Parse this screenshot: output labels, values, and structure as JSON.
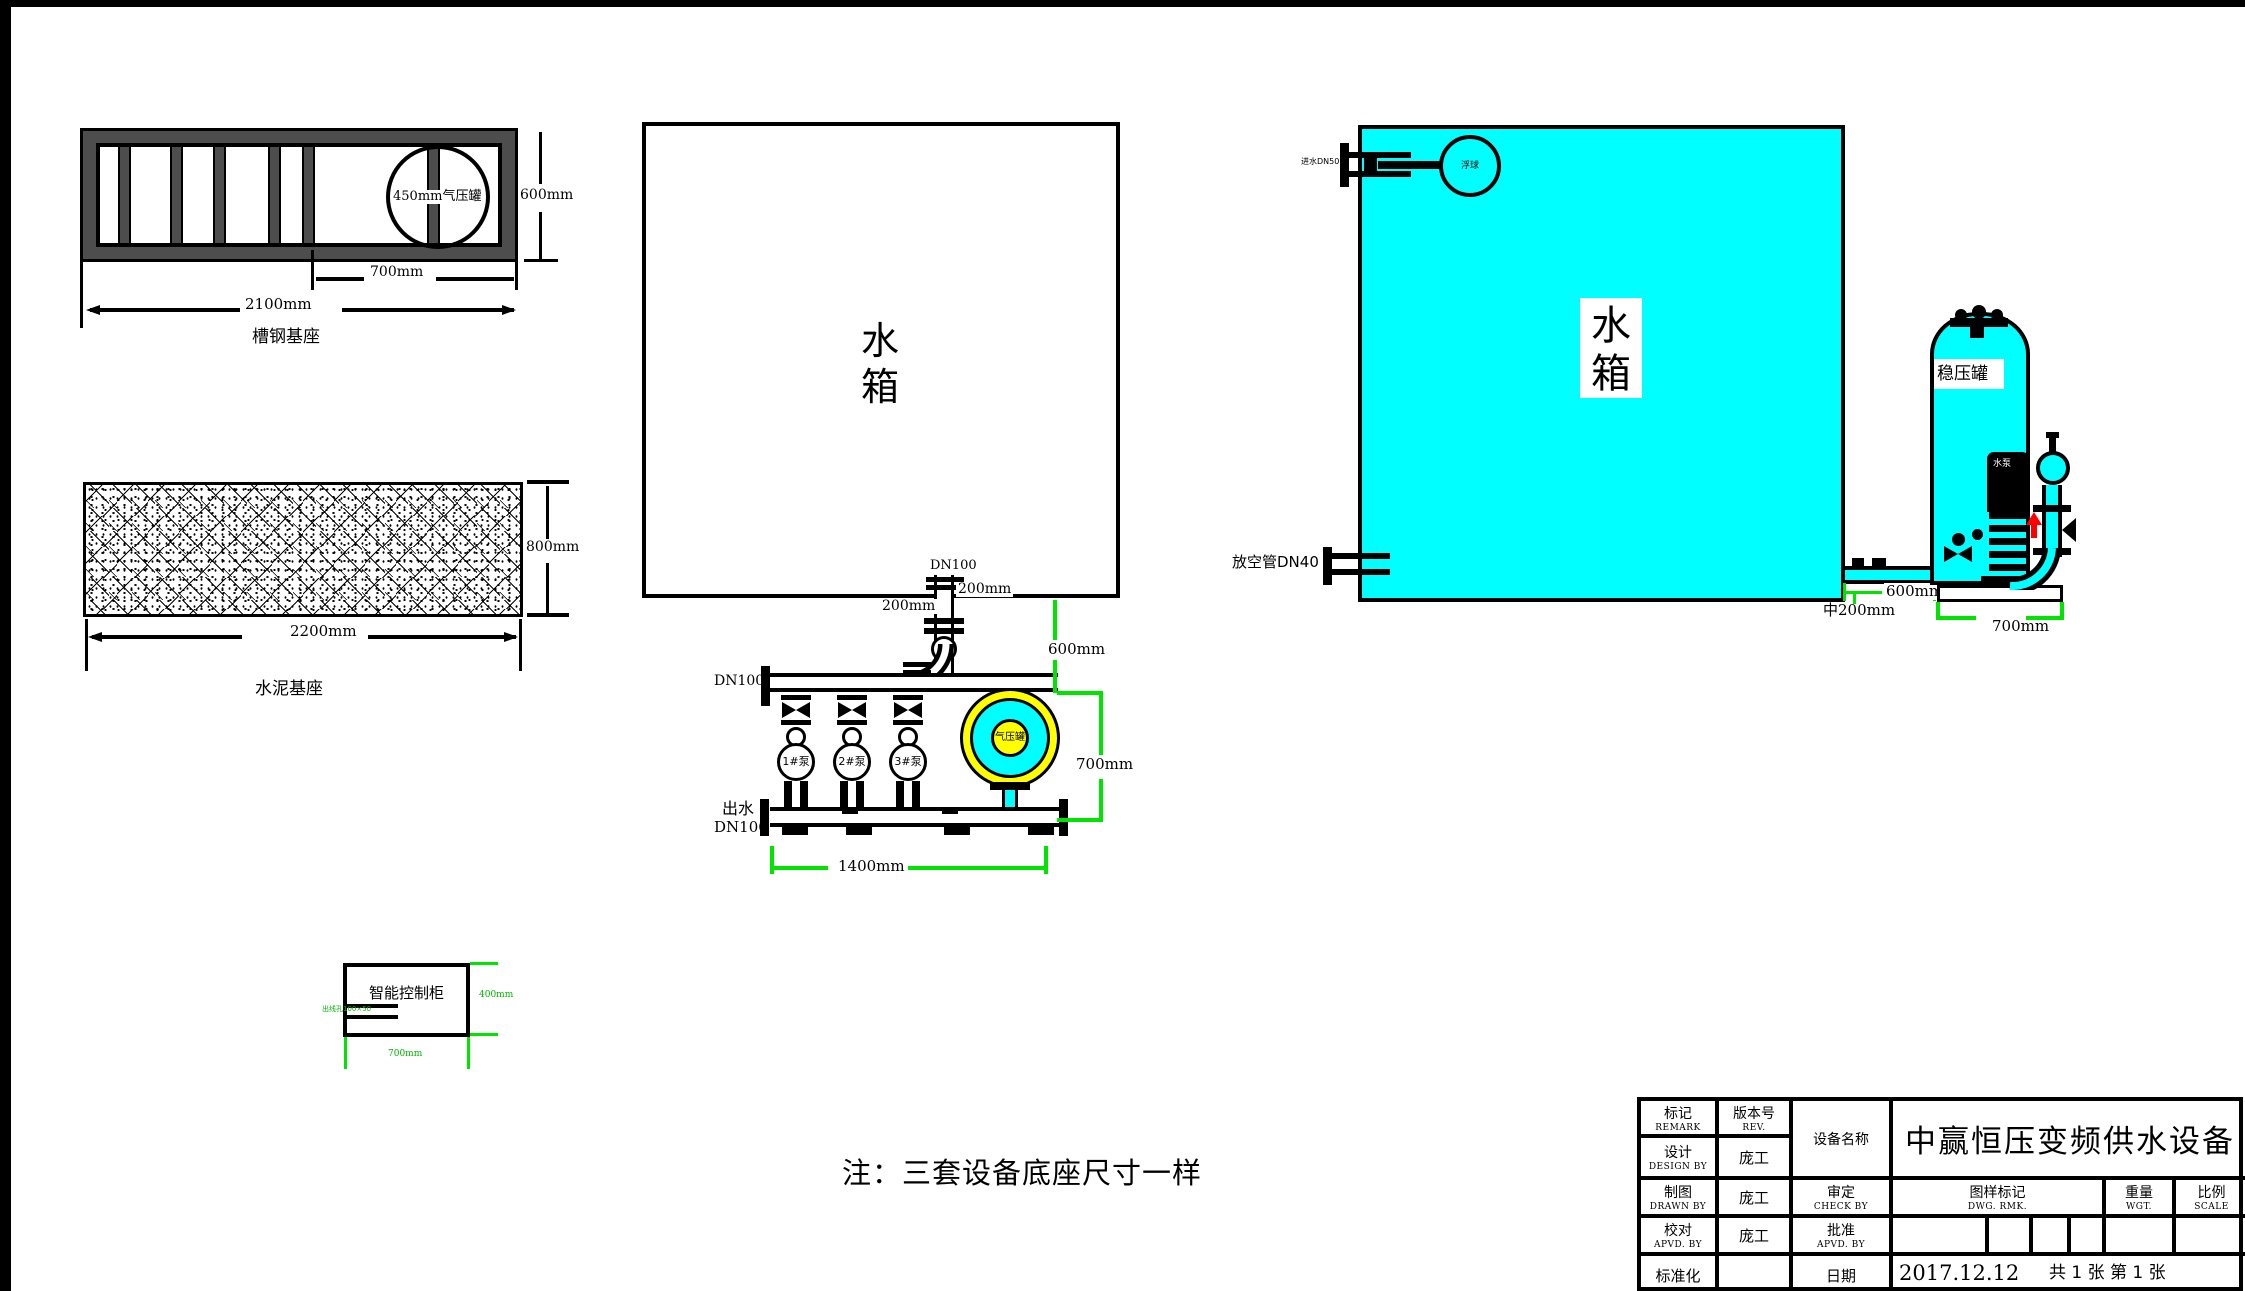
{
  "colors": {
    "cyan": "#00FFFF",
    "yellow": "#FFFF00",
    "dim_green": "#00E400",
    "arrow_red": "#FF0000",
    "steel_gray": "#4D4D4D",
    "line_black": "#000000"
  },
  "channel_base": {
    "caption": "槽钢基座",
    "tank_circle_label": "450mm气压罐",
    "dim_height": "600mm",
    "dim_tank": "700mm",
    "dim_total": "2100mm"
  },
  "cement_base": {
    "caption": "水泥基座",
    "dim_height": "800mm",
    "dim_width": "2200mm"
  },
  "pump_skid": {
    "tank_label": "水箱",
    "inlet_dn": "DN100",
    "offset_left": "200mm",
    "offset_right": "200mm",
    "manifold_dn": "DN100",
    "outlet_label": "出水",
    "outlet_dn": "DN100",
    "pumps": [
      "1#泵",
      "2#泵",
      "3#泵"
    ],
    "air_tank_label": "气压罐",
    "dim_drop": "600mm",
    "dim_height": "700mm",
    "dim_width": "1400mm"
  },
  "side_view": {
    "tank_label": "水箱",
    "inlet_label": "进水DN50",
    "float_label": "浮球",
    "drain_label": "放空管DN40",
    "surge_tank_label": "稳压罐",
    "pump_label": "水泵",
    "dim_gap": "600mm",
    "dim_pipe": "中200mm",
    "dim_base": "700mm"
  },
  "control_cabinet": {
    "label": "智能控制柜",
    "slot_note": "出线孔100×50",
    "dim_height": "400mm",
    "dim_width": "700mm"
  },
  "note": "注：三套设备底座尺寸一样",
  "title_block": {
    "remark_cn": "标记",
    "remark_en": "REMARK",
    "rev_cn": "版本号",
    "rev_en": "REV.",
    "device_name_label": "设备名称",
    "title": "中赢恒压变频供水设备",
    "design_cn": "设计",
    "design_en": "DESIGN BY",
    "draw_cn": "制图",
    "draw_en": "DRAWN BY",
    "proof_cn": "校对",
    "proof_en": "APVD. BY",
    "std_cn": "标准化",
    "designer1": "庞工",
    "designer2": "庞工",
    "designer3": "庞工",
    "check_cn": "审定",
    "check_en": "CHECK BY",
    "approve_cn": "批准",
    "approve_en": "APVD. BY",
    "date_label": "日期",
    "dwg_cn": "图样标记",
    "dwg_en": "DWG.  RMK.",
    "weight_cn": "重量",
    "weight_en": "WGT.",
    "scale_cn": "比例",
    "scale_en": "SCALE",
    "date_value": "2017.12.12",
    "sheet_info": "共 1 张  第 1 张"
  }
}
